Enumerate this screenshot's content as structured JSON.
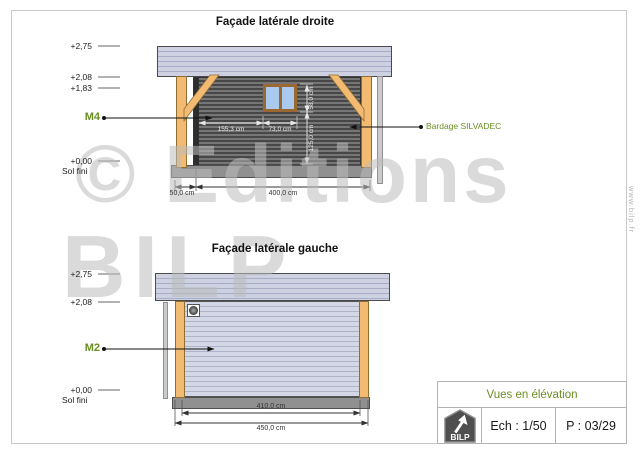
{
  "watermark": {
    "line1": "© Editions",
    "line2": "BILP"
  },
  "site_url": "www.bilp.fr",
  "views": {
    "right": {
      "title": "Façade latérale droite",
      "marker_label": "M4",
      "callout_label": "Bardage SILVADEC",
      "levels": [
        {
          "label": "+2,75"
        },
        {
          "label": "+2,08"
        },
        {
          "label": "+1,83"
        },
        {
          "label": "+0,00",
          "sub": "Sol fini"
        }
      ],
      "dims": {
        "post_offset": "50,0 cm",
        "wall_length": "400,0 cm",
        "window_offset": "155,3 cm",
        "window_width": "73,0 cm",
        "window_height": "58,0 cm",
        "sill_height": "125,0 cm"
      }
    },
    "left": {
      "title": "Façade latérale gauche",
      "marker_label": "M2",
      "levels": [
        {
          "label": "+2,75"
        },
        {
          "label": "+2,08"
        },
        {
          "label": "+0,00",
          "sub": "Sol fini"
        }
      ],
      "dims": {
        "inner_length": "410,0 cm",
        "overall_length": "450,0 cm"
      }
    }
  },
  "title_block": {
    "title": "Vues en élévation",
    "scale": "Ech : 1/50",
    "page": "P : 03/29",
    "logo_text": "BILP"
  },
  "colors": {
    "accent_olive": "#6b8e23",
    "wood_post": "#f3bb72",
    "roof_panel": "#cdd1e2",
    "cladding_dark": "#5f5f5f",
    "cladding_light": "#ced3e3",
    "base_concrete": "#8d8d8d",
    "window_glass": "#aac9ef",
    "window_frame": "#9a6830"
  }
}
